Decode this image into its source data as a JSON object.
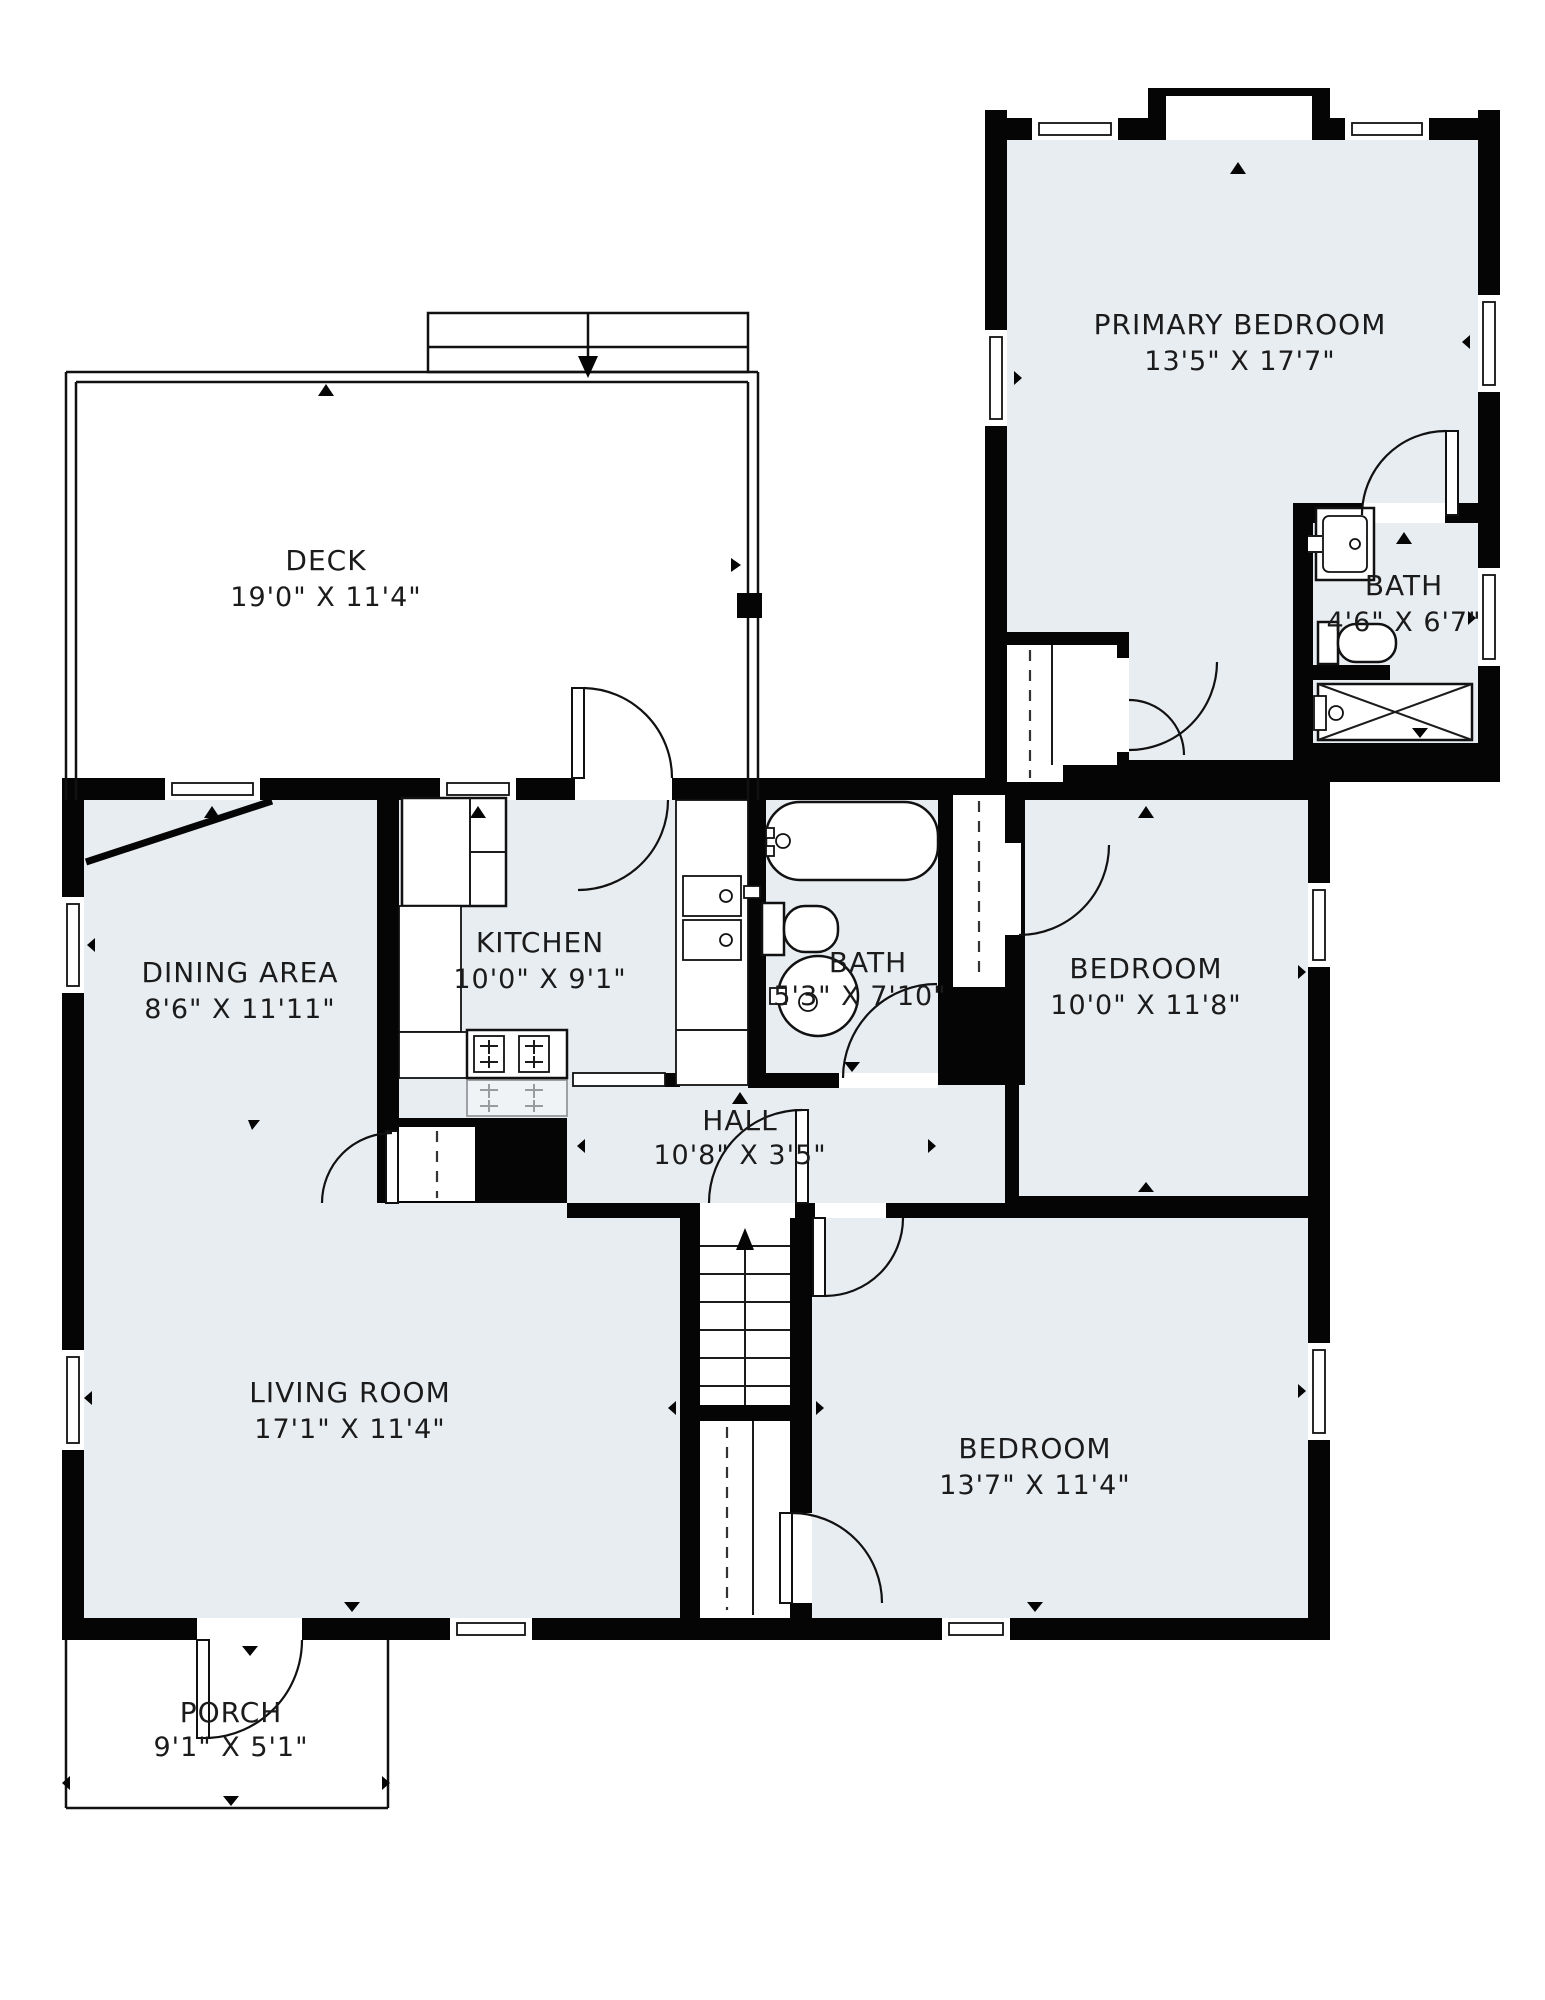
{
  "plan": {
    "colors": {
      "wall": "#050505",
      "room_fill": "#e8edf2",
      "background": "#ffffff",
      "line": "#1b1b1b"
    },
    "rooms": [
      {
        "id": "deck",
        "name": "DECK",
        "dims": "19'0\" X 11'4\""
      },
      {
        "id": "primary-bedroom",
        "name": "PRIMARY BEDROOM",
        "dims": "13'5\" X 17'7\""
      },
      {
        "id": "primary-bath",
        "name": "BATH",
        "dims": "4'6\" X 6'7\""
      },
      {
        "id": "dining-area",
        "name": "DINING AREA",
        "dims": "8'6\" X 11'11\""
      },
      {
        "id": "kitchen",
        "name": "KITCHEN",
        "dims": "10'0\" X 9'1\""
      },
      {
        "id": "hall-bath",
        "name": "BATH",
        "dims": "5'3\" X 7'10\""
      },
      {
        "id": "bedroom-middle",
        "name": "BEDROOM",
        "dims": "10'0\" X 11'8\""
      },
      {
        "id": "hall",
        "name": "HALL",
        "dims": "10'8\" X 3'5\""
      },
      {
        "id": "living-room",
        "name": "LIVING ROOM",
        "dims": "17'1\" X 11'4\""
      },
      {
        "id": "bedroom-bottom",
        "name": "BEDROOM",
        "dims": "13'7\" X 11'4\""
      },
      {
        "id": "porch",
        "name": "PORCH",
        "dims": "9'1\" X 5'1\""
      }
    ]
  }
}
